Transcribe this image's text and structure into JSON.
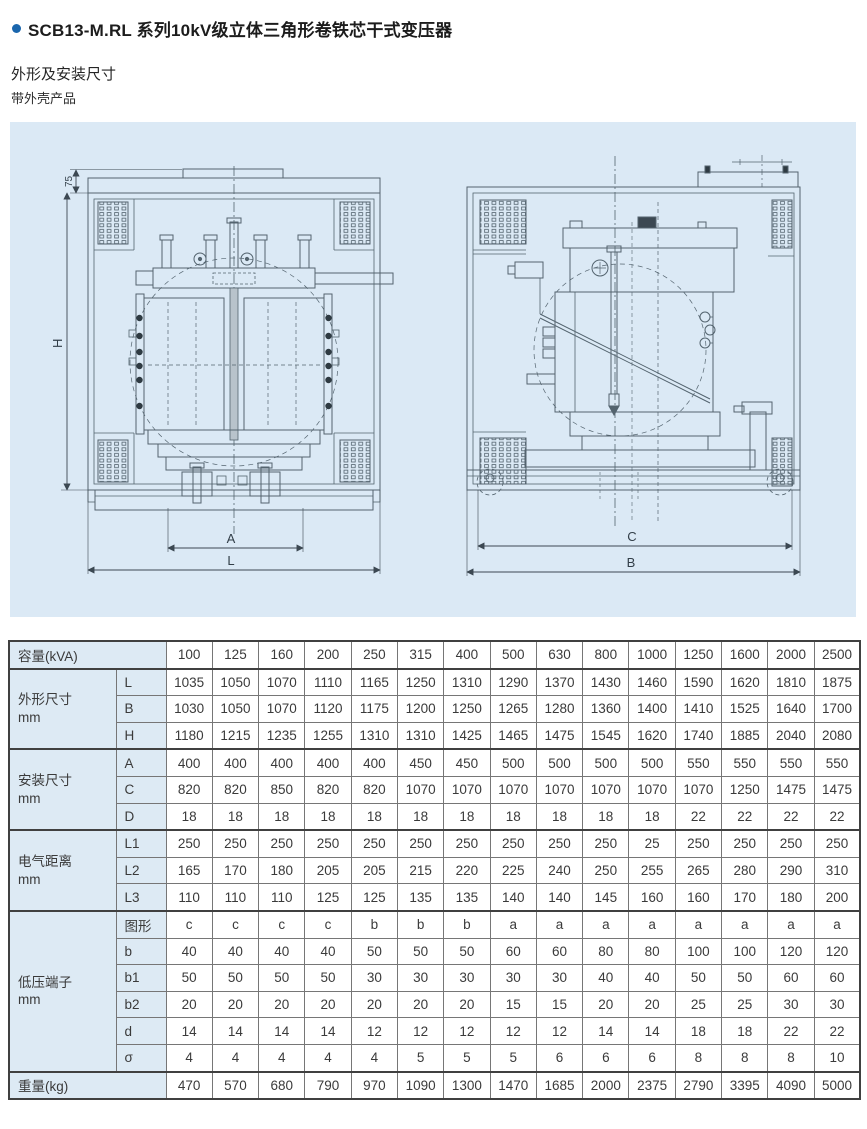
{
  "page": {
    "title": "SCB13-M.RL 系列10kV级立体三角形卷铁芯干式变压器",
    "subtitle": "外形及安装尺寸",
    "note": "带外壳产品"
  },
  "colors": {
    "accent_blue": "#1a66ad",
    "panel_background": "#dbe9f5",
    "drawing_line": "#54646f",
    "table_label_background": "#ddeaf4",
    "table_border_dark": "#404040",
    "table_border_light": "#767676",
    "text": "#3a3a3a"
  },
  "drawings": {
    "front": {
      "dim_cap": "75",
      "dim_height": "H",
      "dim_inner_width": "A",
      "dim_outer_width": "L"
    },
    "side": {
      "dim_inner_width": "C",
      "dim_outer_width": "B"
    }
  },
  "table": {
    "header": {
      "label": "容量(kVA)",
      "capacities": [
        "100",
        "125",
        "160",
        "200",
        "250",
        "315",
        "400",
        "500",
        "630",
        "800",
        "1000",
        "1250",
        "1600",
        "2000",
        "2500"
      ]
    },
    "groups": [
      {
        "label": "外形尺寸",
        "unit": "mm",
        "rows": [
          {
            "name": "L",
            "values": [
              "1035",
              "1050",
              "1070",
              "1110",
              "1165",
              "1250",
              "1310",
              "1290",
              "1370",
              "1430",
              "1460",
              "1590",
              "1620",
              "1810",
              "1875"
            ]
          },
          {
            "name": "B",
            "values": [
              "1030",
              "1050",
              "1070",
              "1120",
              "1175",
              "1200",
              "1250",
              "1265",
              "1280",
              "1360",
              "1400",
              "1410",
              "1525",
              "1640",
              "1700"
            ]
          },
          {
            "name": "H",
            "values": [
              "1180",
              "1215",
              "1235",
              "1255",
              "1310",
              "1310",
              "1425",
              "1465",
              "1475",
              "1545",
              "1620",
              "1740",
              "1885",
              "2040",
              "2080"
            ]
          }
        ]
      },
      {
        "label": "安装尺寸",
        "unit": "mm",
        "rows": [
          {
            "name": "A",
            "values": [
              "400",
              "400",
              "400",
              "400",
              "400",
              "450",
              "450",
              "500",
              "500",
              "500",
              "500",
              "550",
              "550",
              "550",
              "550"
            ]
          },
          {
            "name": "C",
            "values": [
              "820",
              "820",
              "850",
              "820",
              "820",
              "1070",
              "1070",
              "1070",
              "1070",
              "1070",
              "1070",
              "1070",
              "1250",
              "1475",
              "1475"
            ]
          },
          {
            "name": "D",
            "values": [
              "18",
              "18",
              "18",
              "18",
              "18",
              "18",
              "18",
              "18",
              "18",
              "18",
              "18",
              "22",
              "22",
              "22",
              "22"
            ]
          }
        ]
      },
      {
        "label": "电气距离",
        "unit": "mm",
        "rows": [
          {
            "name": "L1",
            "values": [
              "250",
              "250",
              "250",
              "250",
              "250",
              "250",
              "250",
              "250",
              "250",
              "250",
              "25",
              "250",
              "250",
              "250",
              "250"
            ]
          },
          {
            "name": "L2",
            "values": [
              "165",
              "170",
              "180",
              "205",
              "205",
              "215",
              "220",
              "225",
              "240",
              "250",
              "255",
              "265",
              "280",
              "290",
              "310"
            ]
          },
          {
            "name": "L3",
            "values": [
              "110",
              "110",
              "110",
              "125",
              "125",
              "135",
              "135",
              "140",
              "140",
              "145",
              "160",
              "160",
              "170",
              "180",
              "200"
            ]
          }
        ]
      },
      {
        "label": "低压端子",
        "unit": "mm",
        "rows": [
          {
            "name": "图形",
            "values": [
              "c",
              "c",
              "c",
              "c",
              "b",
              "b",
              "b",
              "a",
              "a",
              "a",
              "a",
              "a",
              "a",
              "a",
              "a"
            ]
          },
          {
            "name": "b",
            "values": [
              "40",
              "40",
              "40",
              "40",
              "50",
              "50",
              "50",
              "60",
              "60",
              "80",
              "80",
              "100",
              "100",
              "120",
              "120"
            ]
          },
          {
            "name": "b1",
            "values": [
              "50",
              "50",
              "50",
              "50",
              "30",
              "30",
              "30",
              "30",
              "30",
              "40",
              "40",
              "50",
              "50",
              "60",
              "60"
            ]
          },
          {
            "name": "b2",
            "values": [
              "20",
              "20",
              "20",
              "20",
              "20",
              "20",
              "20",
              "15",
              "15",
              "20",
              "20",
              "25",
              "25",
              "30",
              "30"
            ]
          },
          {
            "name": "d",
            "values": [
              "14",
              "14",
              "14",
              "14",
              "12",
              "12",
              "12",
              "12",
              "12",
              "14",
              "14",
              "18",
              "18",
              "22",
              "22"
            ]
          },
          {
            "name": "σ",
            "values": [
              "4",
              "4",
              "4",
              "4",
              "4",
              "5",
              "5",
              "5",
              "6",
              "6",
              "6",
              "8",
              "8",
              "8",
              "10"
            ]
          }
        ]
      }
    ],
    "footer": {
      "label": "重量(kg)",
      "values": [
        "470",
        "570",
        "680",
        "790",
        "970",
        "1090",
        "1300",
        "1470",
        "1685",
        "2000",
        "2375",
        "2790",
        "3395",
        "4090",
        "5000"
      ]
    }
  }
}
